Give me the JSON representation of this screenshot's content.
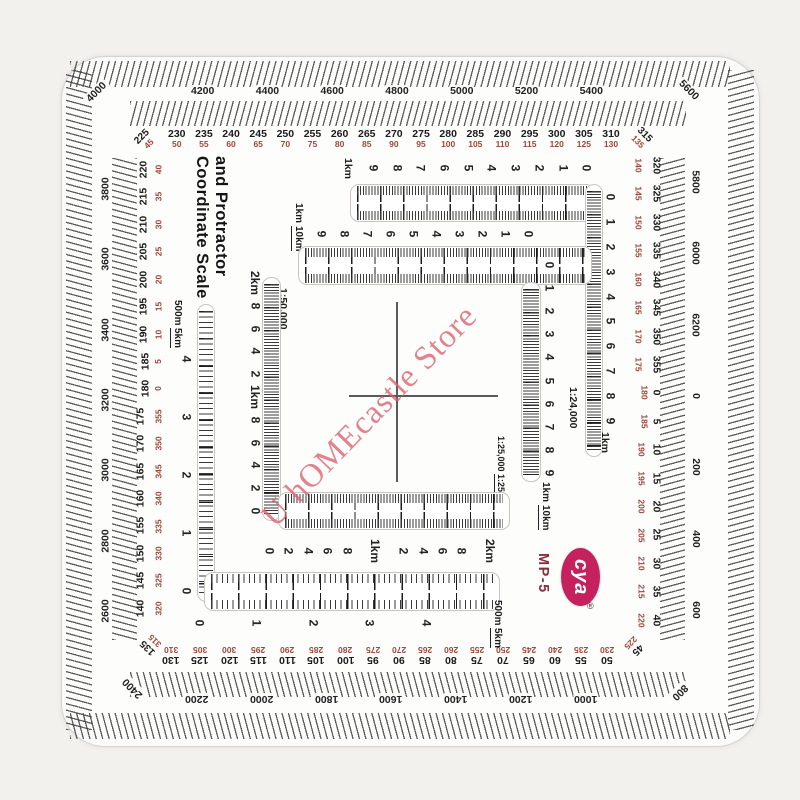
{
  "product": {
    "title_line1": "Coordinate Scale",
    "title_line2": "and Protractor",
    "brand": "cya",
    "registered": "®",
    "model": "MP-5"
  },
  "watermark": {
    "text": "U hOMEcastle Store",
    "color": "#d95f6e"
  },
  "colors": {
    "brand_oval": "#c6215f",
    "model_text": "#8d2c3c",
    "degree_secondary_red": "#9c473d",
    "tick_black": "#333333",
    "plastic_white": "#fdfdfc"
  },
  "protractor": {
    "mils": {
      "top": [
        "4200",
        "4400",
        "4600",
        "4800",
        "5000",
        "5200",
        "5400"
      ],
      "right": [
        "5800",
        "6000",
        "6200",
        "0",
        "200",
        "400",
        "600"
      ],
      "bottom": [
        "2200",
        "2000",
        "1800",
        "1600",
        "1400",
        "1200",
        "1000"
      ],
      "left": [
        "3800",
        "3600",
        "3400",
        "3200",
        "3000",
        "2800",
        "2600"
      ]
    },
    "corners": {
      "tl": {
        "mils": "4000",
        "deg": "225",
        "deg2": "45"
      },
      "tr": {
        "mils": "5600",
        "deg": "315",
        "deg2": "135"
      },
      "br": {
        "mils": "800",
        "deg": "45",
        "deg2": "225"
      },
      "bl": {
        "mils": "2400",
        "deg": "135",
        "deg2": "315"
      }
    },
    "degrees": {
      "top": [
        {
          "b": "230",
          "r": "50"
        },
        {
          "b": "235",
          "r": "55"
        },
        {
          "b": "240",
          "r": "60"
        },
        {
          "b": "245",
          "r": "65"
        },
        {
          "b": "250",
          "r": "70"
        },
        {
          "b": "255",
          "r": "75"
        },
        {
          "b": "260",
          "r": "80"
        },
        {
          "b": "265",
          "r": "85"
        },
        {
          "b": "270",
          "r": "90"
        },
        {
          "b": "275",
          "r": "95"
        },
        {
          "b": "280",
          "r": "100"
        },
        {
          "b": "285",
          "r": "105"
        },
        {
          "b": "290",
          "r": "110"
        },
        {
          "b": "295",
          "r": "115"
        },
        {
          "b": "300",
          "r": "120"
        },
        {
          "b": "305",
          "r": "125"
        },
        {
          "b": "310",
          "r": "130"
        }
      ],
      "right": [
        {
          "b": "320",
          "r": "140"
        },
        {
          "b": "325",
          "r": "145"
        },
        {
          "b": "330",
          "r": "150"
        },
        {
          "b": "335",
          "r": "155"
        },
        {
          "b": "340",
          "r": "160"
        },
        {
          "b": "345",
          "r": "165"
        },
        {
          "b": "350",
          "r": "170"
        },
        {
          "b": "355",
          "r": "175"
        },
        {
          "b": "0",
          "r": "180"
        },
        {
          "b": "5",
          "r": "185"
        },
        {
          "b": "10",
          "r": "190"
        },
        {
          "b": "15",
          "r": "195"
        },
        {
          "b": "20",
          "r": "200"
        },
        {
          "b": "25",
          "r": "205"
        },
        {
          "b": "30",
          "r": "210"
        },
        {
          "b": "35",
          "r": "215"
        },
        {
          "b": "40",
          "r": "220"
        }
      ],
      "bottom": [
        {
          "b": "130",
          "r": "310"
        },
        {
          "b": "125",
          "r": "305"
        },
        {
          "b": "120",
          "r": "300"
        },
        {
          "b": "115",
          "r": "295"
        },
        {
          "b": "110",
          "r": "290"
        },
        {
          "b": "105",
          "r": "285"
        },
        {
          "b": "100",
          "r": "280"
        },
        {
          "b": "95",
          "r": "275"
        },
        {
          "b": "90",
          "r": "270"
        },
        {
          "b": "85",
          "r": "265"
        },
        {
          "b": "80",
          "r": "260"
        },
        {
          "b": "75",
          "r": "255"
        },
        {
          "b": "70",
          "r": "250"
        },
        {
          "b": "65",
          "r": "245"
        },
        {
          "b": "60",
          "r": "240"
        },
        {
          "b": "55",
          "r": "235"
        },
        {
          "b": "50",
          "r": "230"
        }
      ],
      "left": [
        {
          "b": "220",
          "r": "40"
        },
        {
          "b": "215",
          "r": "35"
        },
        {
          "b": "210",
          "r": "30"
        },
        {
          "b": "205",
          "r": "25"
        },
        {
          "b": "200",
          "r": "20"
        },
        {
          "b": "195",
          "r": "15"
        },
        {
          "b": "190",
          "r": "10"
        },
        {
          "b": "185",
          "r": "5"
        },
        {
          "b": "180",
          "r": "0"
        },
        {
          "b": "175",
          "r": "355"
        },
        {
          "b": "170",
          "r": "350"
        },
        {
          "b": "165",
          "r": "345"
        },
        {
          "b": "160",
          "r": "340"
        },
        {
          "b": "155",
          "r": "335"
        },
        {
          "b": "150",
          "r": "330"
        },
        {
          "b": "145",
          "r": "325"
        },
        {
          "b": "140",
          "r": "320"
        }
      ]
    }
  },
  "scales": {
    "s24k": {
      "label": "1:24,000",
      "unit_h": "1km",
      "unit_v": "1km",
      "h_numbers": [
        "9",
        "8",
        "7",
        "6",
        "5",
        "4",
        "3",
        "2",
        "1",
        "0"
      ],
      "v_numbers": [
        "0",
        "1",
        "2",
        "3",
        "4",
        "5",
        "6",
        "7",
        "8",
        "9"
      ]
    },
    "s25k": {
      "label_top": "1:25,000",
      "label_bottom": "1:250,000",
      "unit_top": "1km",
      "unit_bottom": "10km",
      "h_numbers": [
        "9",
        "8",
        "7",
        "6",
        "5",
        "4",
        "3",
        "2",
        "1",
        "0"
      ],
      "v_numbers": [
        "0",
        "1",
        "2",
        "3",
        "4",
        "5",
        "6",
        "7",
        "8",
        "9"
      ]
    },
    "s50k": {
      "label": "1:50,000",
      "v_numbers": [
        "2km",
        "8",
        "6",
        "4",
        "2",
        "1km",
        "8",
        "6",
        "4",
        "2",
        "0"
      ],
      "h_numbers": [
        "0",
        "2",
        "4",
        "6",
        "8",
        "1km",
        "2",
        "4",
        "6",
        "8",
        "2km"
      ]
    },
    "s10k": {
      "label_top": "1:10,000",
      "label_bottom": "1:100,000",
      "unit_top": "500m",
      "unit_bottom": "5km",
      "v_numbers": [
        "4",
        "3",
        "2",
        "1",
        "0"
      ],
      "h_numbers": [
        "0",
        "1",
        "2",
        "3",
        "4"
      ]
    }
  }
}
